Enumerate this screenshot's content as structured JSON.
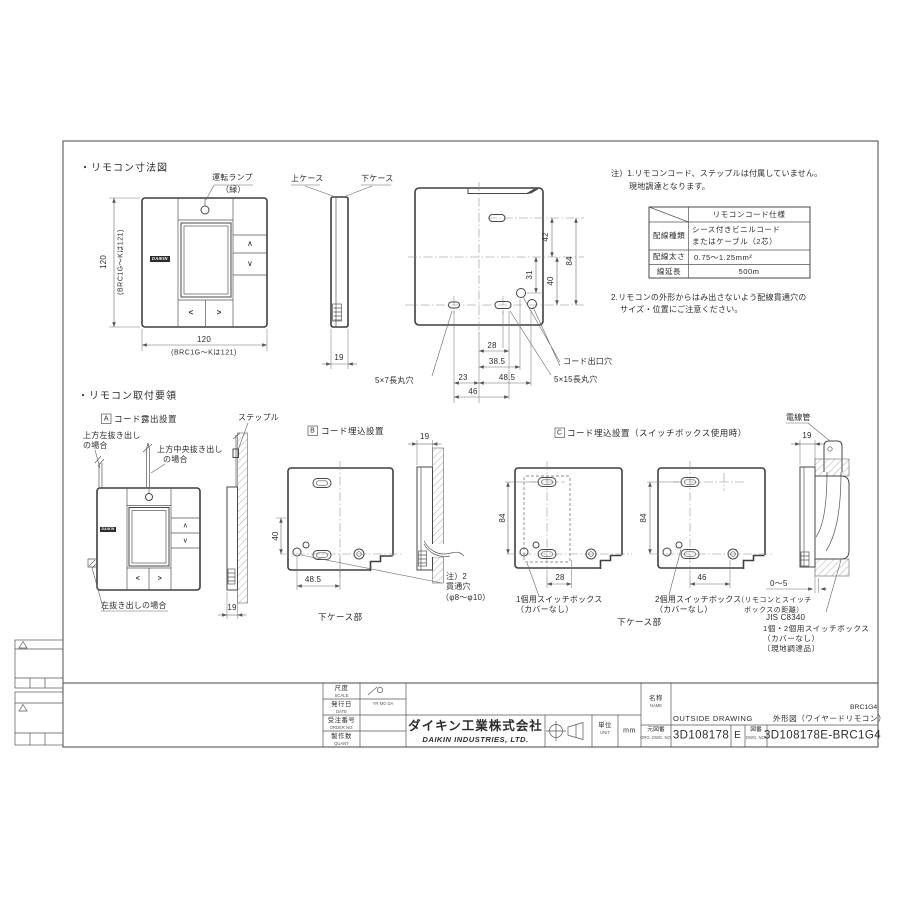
{
  "drawing": {
    "sec1_title": "・リモコン寸法図",
    "sec2_title": "・リモコン取付要領"
  },
  "remote": {
    "up": "∧",
    "down": "∨",
    "left": "<",
    "right": ">",
    "logo": "DAIKIN"
  },
  "front": {
    "lamp1": "運転ランプ",
    "lamp2": "（緑）",
    "upper_case": "上ケース",
    "lower_case": "下ケース",
    "h": "120",
    "h_note": "(BRC1G〜Kは121)",
    "w": "120",
    "w_note": "(BRC1G〜Kは121)",
    "d": "19"
  },
  "back": {
    "d42": "42",
    "d84": "84",
    "d31": "31",
    "d40": "40",
    "d28": "28",
    "d385": "38.5",
    "d23": "23",
    "d485": "48.5",
    "d46": "46",
    "hole57": "5×7長丸穴",
    "cord_exit": "コード出口穴",
    "hole515": "5×15長丸穴"
  },
  "notes": {
    "n1a": "注）1.リモコンコード、ステップルは付属していません。",
    "n1b": "現地調達となります。",
    "n2a": "2.リモコンの外形からはみ出さないよう配線貫通穴の",
    "n2b": "サイズ・位置にご注意ください。"
  },
  "cord_table": {
    "header": "リモコンコード仕様",
    "rows": [
      {
        "label": "配線種類",
        "value_line1": "シース付きビニルコード",
        "value_line2": "またはケーブル（2芯）"
      },
      {
        "label": "配線太さ",
        "value_line1": "0.75〜1.25mm²",
        "value_line2": ""
      },
      {
        "label": "線延長",
        "value_line1": "500m",
        "value_line2": ""
      }
    ]
  },
  "secA": {
    "tag": "A",
    "title": "コード露出設置",
    "tl1": "上方左抜き出し",
    "tl2": "の場合",
    "tc1": "上方中央抜き出し",
    "tc2": "の場合",
    "staple": "ステップル",
    "left_case": "左抜き出しの場合",
    "d19": "19"
  },
  "secB": {
    "tag": "B",
    "title": "コード埋込設置",
    "d19": "19",
    "d40": "40",
    "d485": "48.5",
    "note1": "注）2",
    "note2": "貫通穴",
    "note3": "（φ8〜φ10）",
    "bottom": "下ケース部"
  },
  "secC": {
    "tag": "C",
    "title": "コード埋込設置（スイッチボックス使用時）",
    "d84a": "84",
    "d28": "28",
    "d84b": "84",
    "d46": "46",
    "box1a": "1個用スイッチボックス",
    "box1b": "（カバーなし）",
    "box2a": "2個用スイッチボックス",
    "box2b": "（カバーなし）",
    "bottom": "下ケース部"
  },
  "secD": {
    "conduit": "電線管",
    "d19": "19",
    "d05": "0〜5",
    "dist1": "（リモコンとスイッチ",
    "dist2": "ボックスの距離）",
    "jis": "JIS C8340",
    "jis2": "1個・2個用スイッチボックス",
    "jis3": "（カバーなし）",
    "jis4": "〔現地調達品〕"
  },
  "tb": {
    "scale": "尺度",
    "scale_en": "SCALE",
    "date": "発行日",
    "date_en": "DATE",
    "date_val": "YR MO DA",
    "order": "受注番号",
    "order_en": "ORDER NO.",
    "quant": "製作数",
    "quant_en": "QUANT",
    "company": "ダイキン工業株式会社",
    "company_en": "DAIKIN INDUSTRIES, LTD.",
    "unit": "単位",
    "unit_en": "UNIT",
    "unit_val": "mm",
    "name": "名称",
    "name_en": "NAME",
    "dwg_name_en": "OUTSIDE DRAWING",
    "dwg_name_jp": "外形図（ワイヤードリモコン）",
    "model": "BRC1G4",
    "org_label": "元図番",
    "org_label_en": "ORG. DWG. NO.",
    "org_no": "3D108178",
    "rev": "E",
    "dwg_label": "図番",
    "dwg_label_en": "DWG. NO.",
    "dwg_no": "3D108178E-BRC1G4"
  }
}
